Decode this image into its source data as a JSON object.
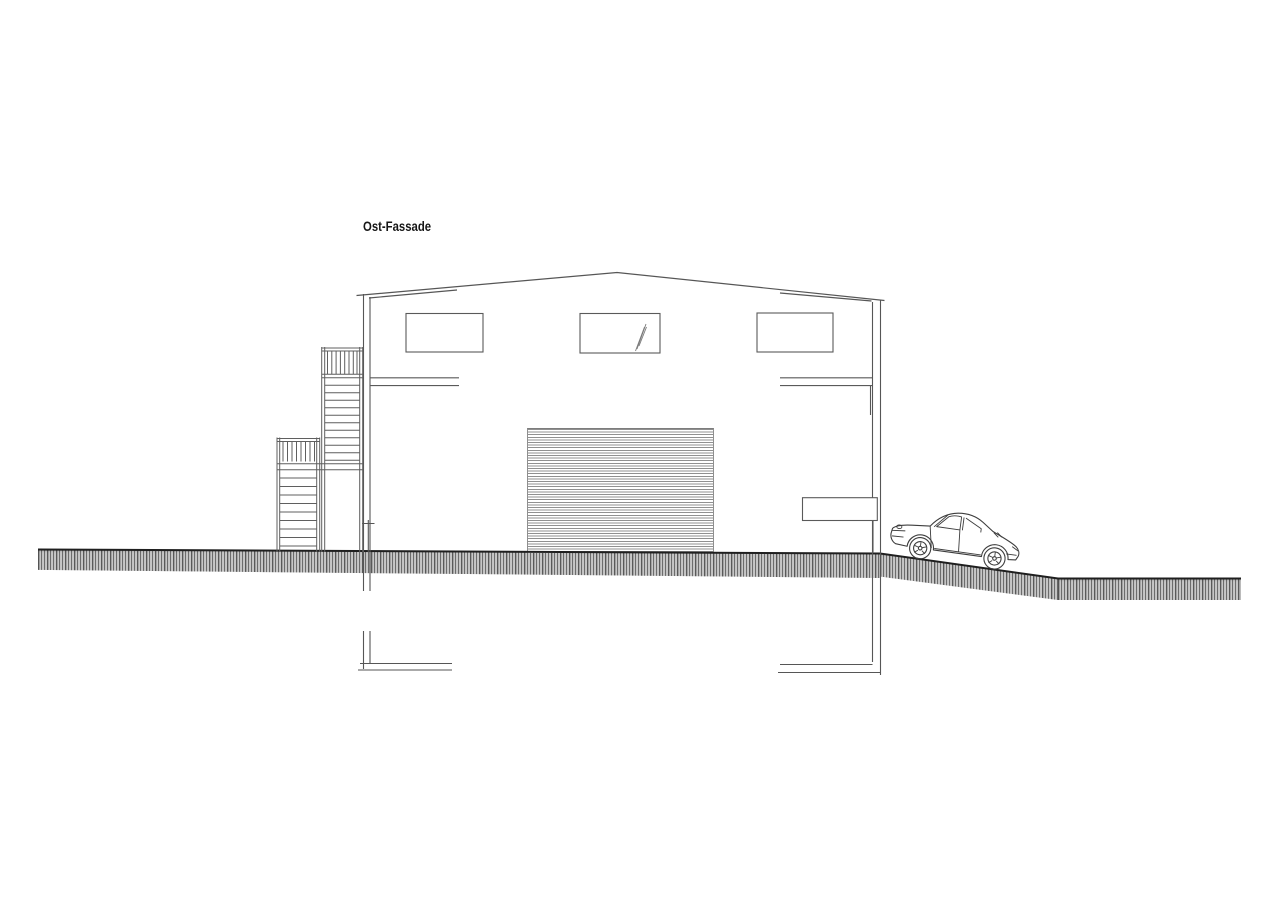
{
  "drawing": {
    "title": "Ost-Fassade"
  },
  "colors": {
    "background": "#ffffff",
    "line": "#4f4f4f",
    "line_dark": "#1f1f1f",
    "hatch_base": "#bdbdbd"
  },
  "elements": {
    "building": "warehouse-east-elevation",
    "roof": "shallow-gable-roof",
    "windows": [
      "upper-window-left",
      "upper-window-middle-with-glazing-mark",
      "upper-window-right"
    ],
    "door": "roller-garage-door",
    "stairs": [
      "upper-exterior-stair-with-railing",
      "lower-exterior-stair-with-railing"
    ],
    "ground": "hatched-grade-line-sloping-down-right",
    "vehicle": "classic-sports-car-side-view",
    "foundation": [
      "left-strip-footing",
      "right-strip-footing"
    ]
  }
}
